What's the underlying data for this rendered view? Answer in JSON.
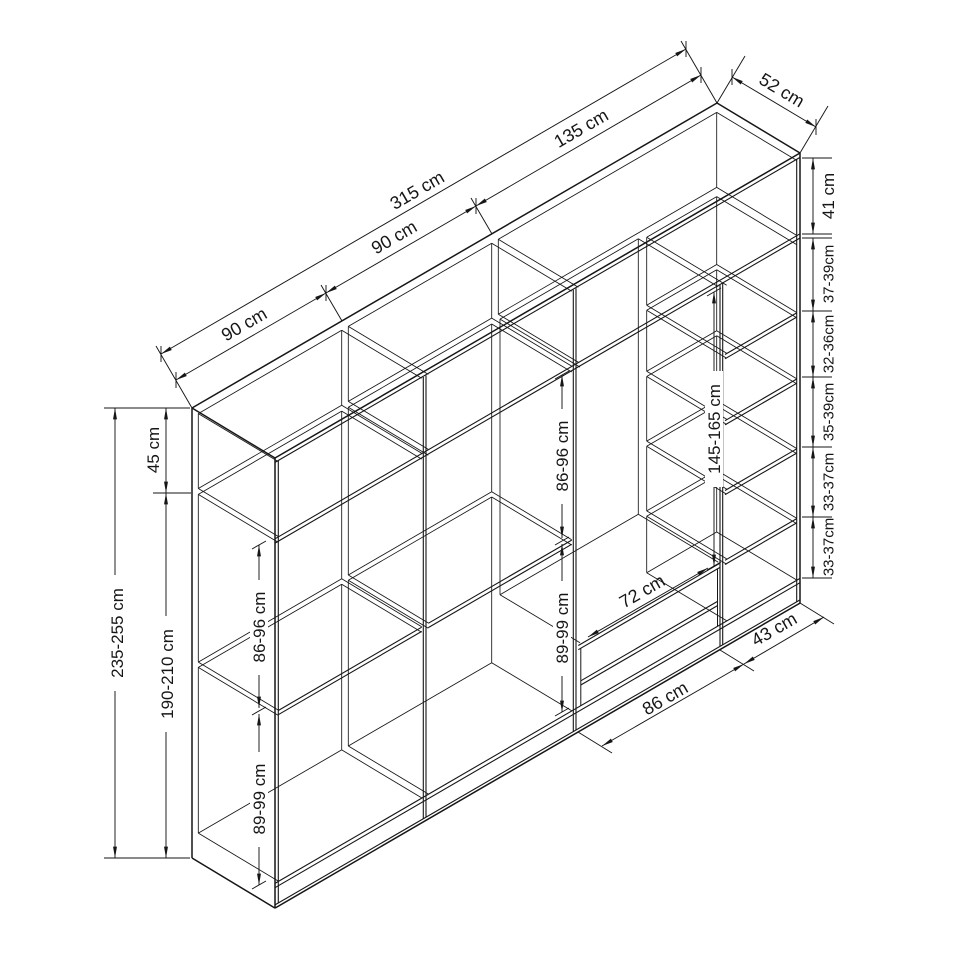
{
  "diagram": {
    "kind": "wardrobe-dimension-drawing",
    "line_color": "#161616",
    "background": "#ffffff"
  },
  "dimensions": {
    "top": {
      "overall_width": "315 cm",
      "segments": [
        "90 cm",
        "90 cm",
        "135 cm"
      ],
      "depth": "52 cm"
    },
    "left": {
      "top_section_height": "45 cm",
      "total_height": "235-255 cm",
      "body_height": "190-210 cm"
    },
    "column1": {
      "upper": "86-96 cm",
      "lower": "89-99 cm"
    },
    "column2": {
      "upper": "86-96 cm",
      "lower": "89-99 cm"
    },
    "hanging_section_height": "145-165 cm",
    "drawer_width": "72 cm",
    "bottom": {
      "hanging_width": "86 cm",
      "shelf_column_width": "43 cm"
    },
    "right": {
      "top_compartment": "41 cm",
      "shelf_gaps": [
        "37-39cm",
        "32-36cm",
        "35-39cm",
        "33-37cm",
        "33-37cm"
      ]
    }
  }
}
